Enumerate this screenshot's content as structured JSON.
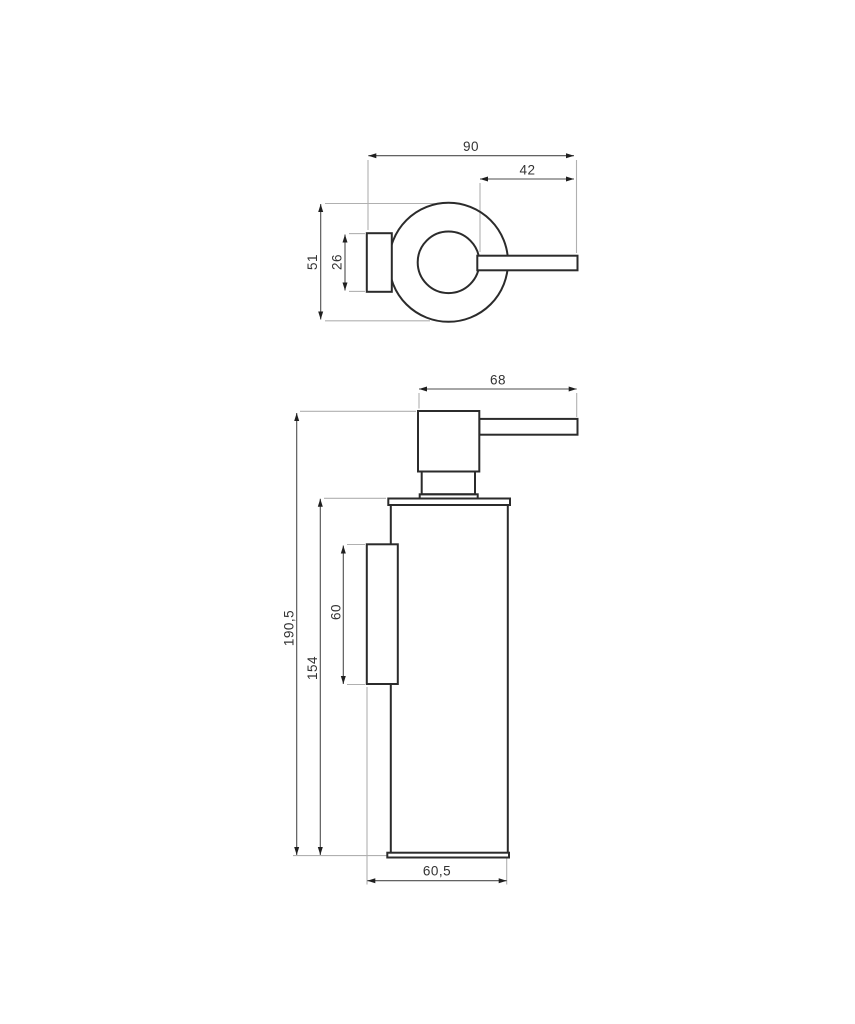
{
  "drawing": {
    "colors": {
      "outline": "#2b2b2b",
      "dim_line": "#4d4d4d",
      "ext_line": "#b0b0b0",
      "arrow": "#1f1f1f",
      "text": "#333333",
      "background": "#ffffff"
    },
    "views": {
      "top": {
        "dim_total_width": "90",
        "dim_spout_length": "42",
        "dim_total_depth": "51",
        "dim_bracket_height": "26"
      },
      "front": {
        "dim_pump_width": "68",
        "dim_total_height": "190,5",
        "dim_body_height": "154",
        "dim_plate_height": "60",
        "dim_bottom_depth": "60,5"
      }
    }
  }
}
